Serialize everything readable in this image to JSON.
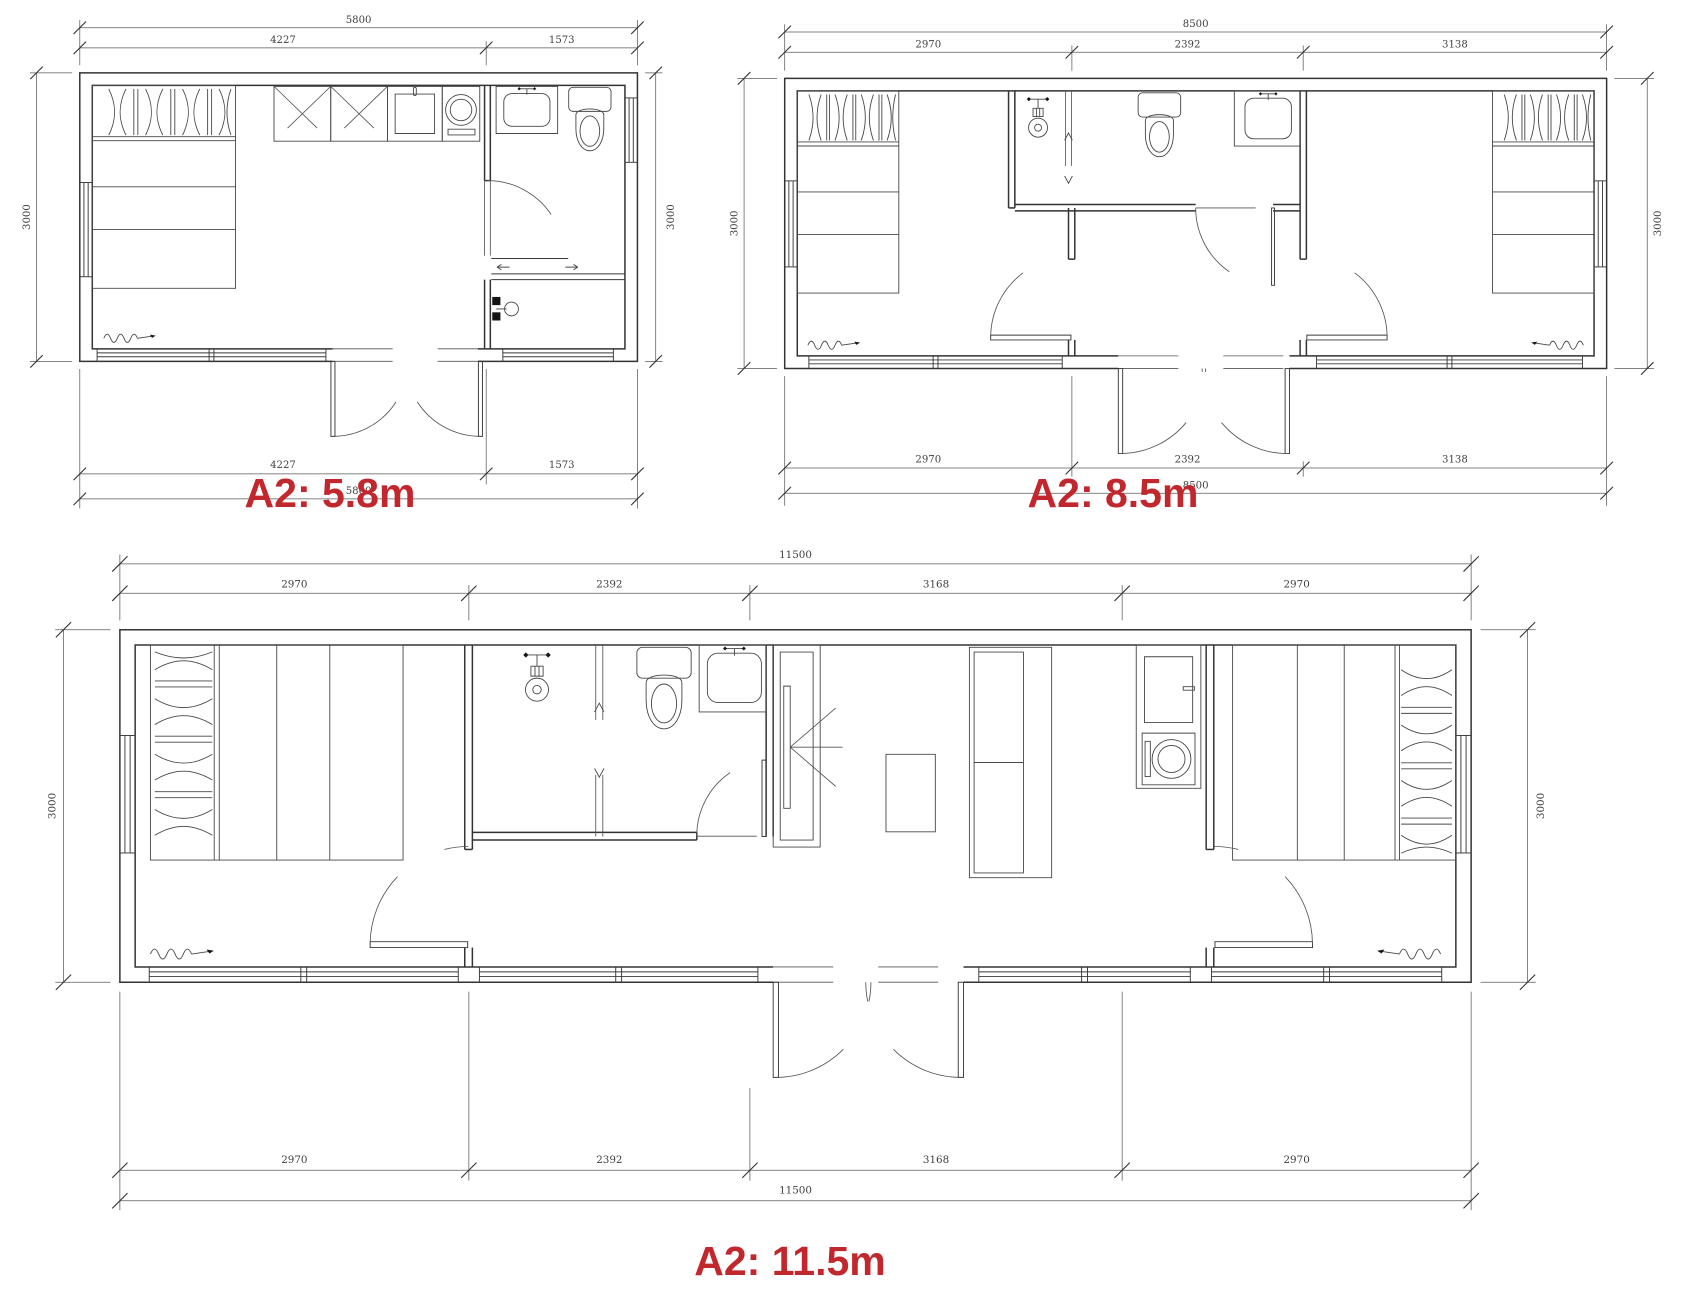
{
  "colors": {
    "accent_red": "#c1272d",
    "line": "#3a3a3a",
    "dim_text": "#3f3f3f",
    "background": "#ffffff"
  },
  "plans": [
    {
      "id": "a2-5-8",
      "label": "A2: 5.8m",
      "total": "5800",
      "top_segments": [
        "4227",
        "1573"
      ],
      "bottom_segments": [
        "4227",
        "1573"
      ],
      "side_left": "3000",
      "side_right": "3000"
    },
    {
      "id": "a2-8-5",
      "label": "A2: 8.5m",
      "total": "8500",
      "top_segments": [
        "2970",
        "2392",
        "3138"
      ],
      "bottom_segments": [
        "2970",
        "2392",
        "3138"
      ],
      "side_left": "3000",
      "side_right": "3000"
    },
    {
      "id": "a2-11-5",
      "label": "A2: 11.5m",
      "total": "11500",
      "top_segments": [
        "2970",
        "2392",
        "3168",
        "2970"
      ],
      "bottom_segments": [
        "2970",
        "2392",
        "3168",
        "2970"
      ],
      "side_left": "3000",
      "side_right": "3000"
    }
  ]
}
